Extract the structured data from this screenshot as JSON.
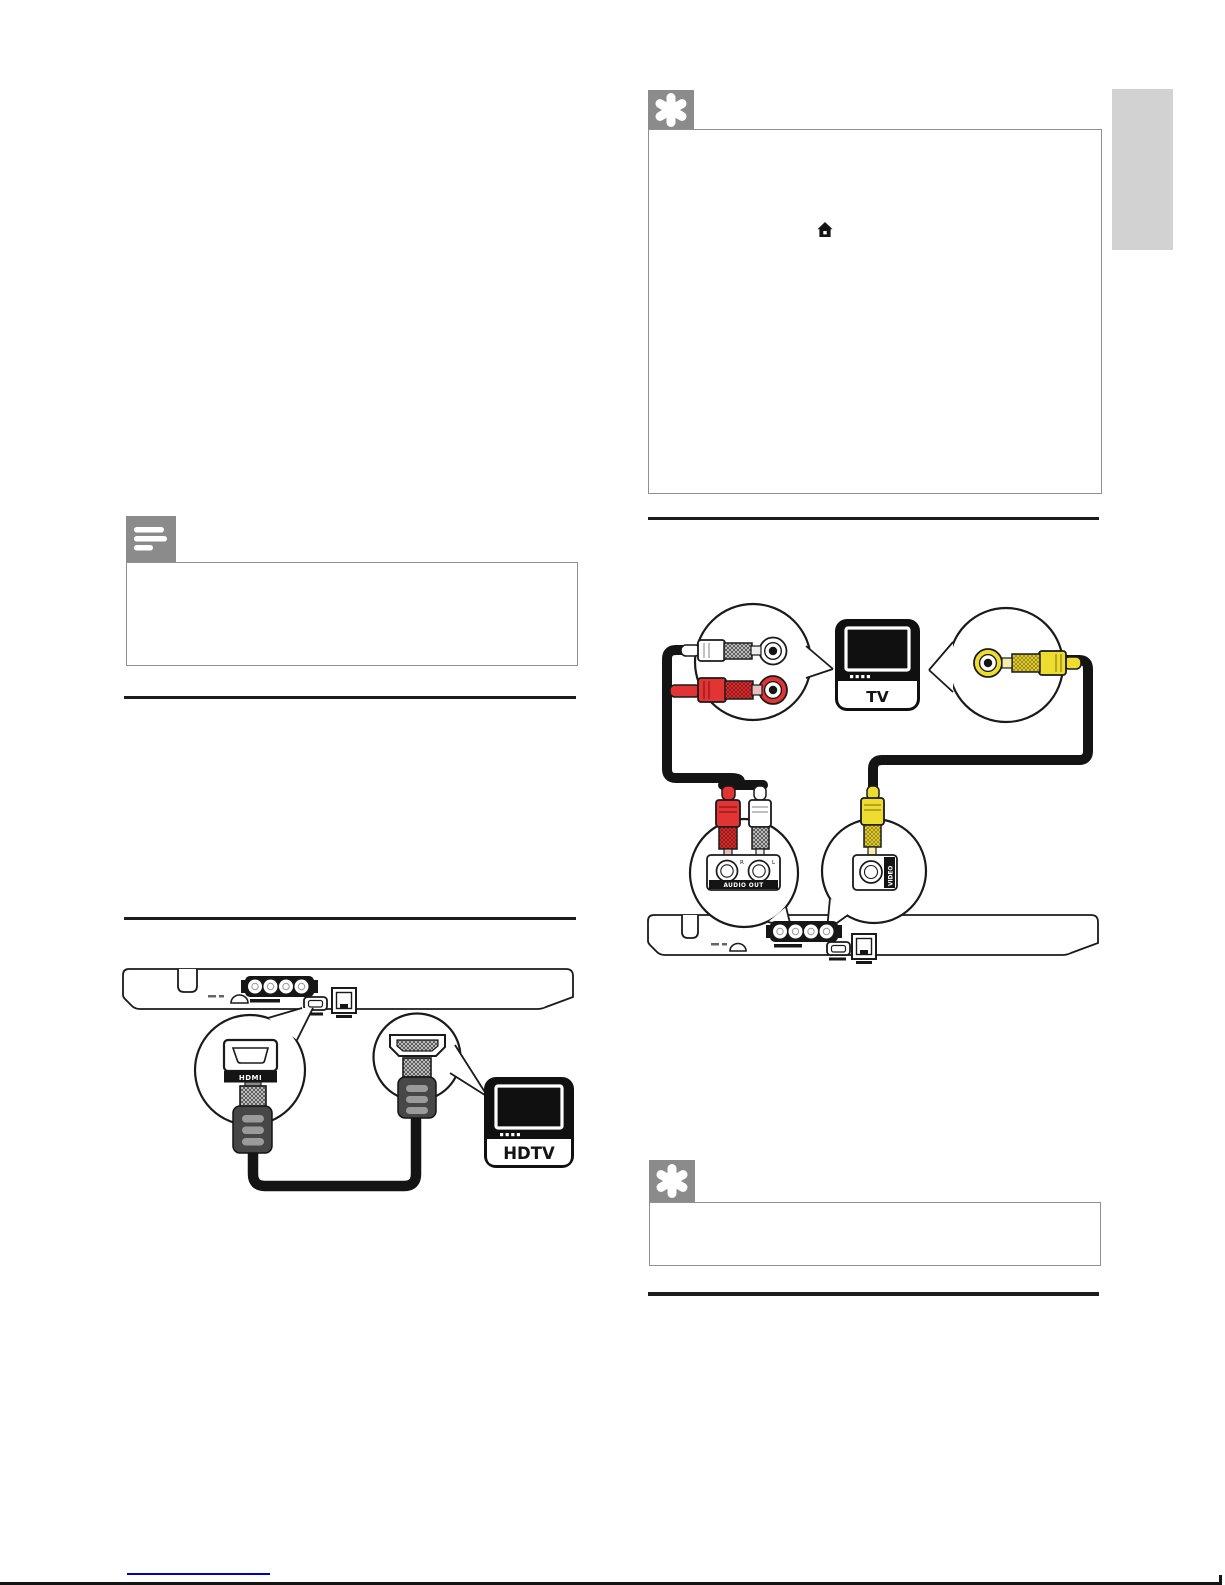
{
  "page": {
    "type": "user-manual-page",
    "side_tab_color": "#d2d2d2",
    "colors": {
      "icon_gray": "#8b8b8b",
      "box_border": "#909090",
      "divider": "#1c1c1c",
      "rca_red": "#e23434",
      "rca_yellow": "#eedd2f",
      "link_blue": "#0000cc",
      "plug_dark": "#474747"
    }
  },
  "tip_box_top": {
    "icon": "asterisk-tip-icon",
    "content_icon": "home-icon"
  },
  "note_box": {
    "icon": "note-lines-icon"
  },
  "tip_box_bottom": {
    "icon": "asterisk-tip-icon"
  },
  "hdmi_diagram": {
    "socket_label": "HDMI",
    "hdtv_label": "HDTV"
  },
  "av_diagram": {
    "tv_label": "TV",
    "audio_out_label": "AUDIO OUT",
    "video_label": "VIDEO",
    "jack_right_label": "R",
    "jack_left_label": "L"
  }
}
